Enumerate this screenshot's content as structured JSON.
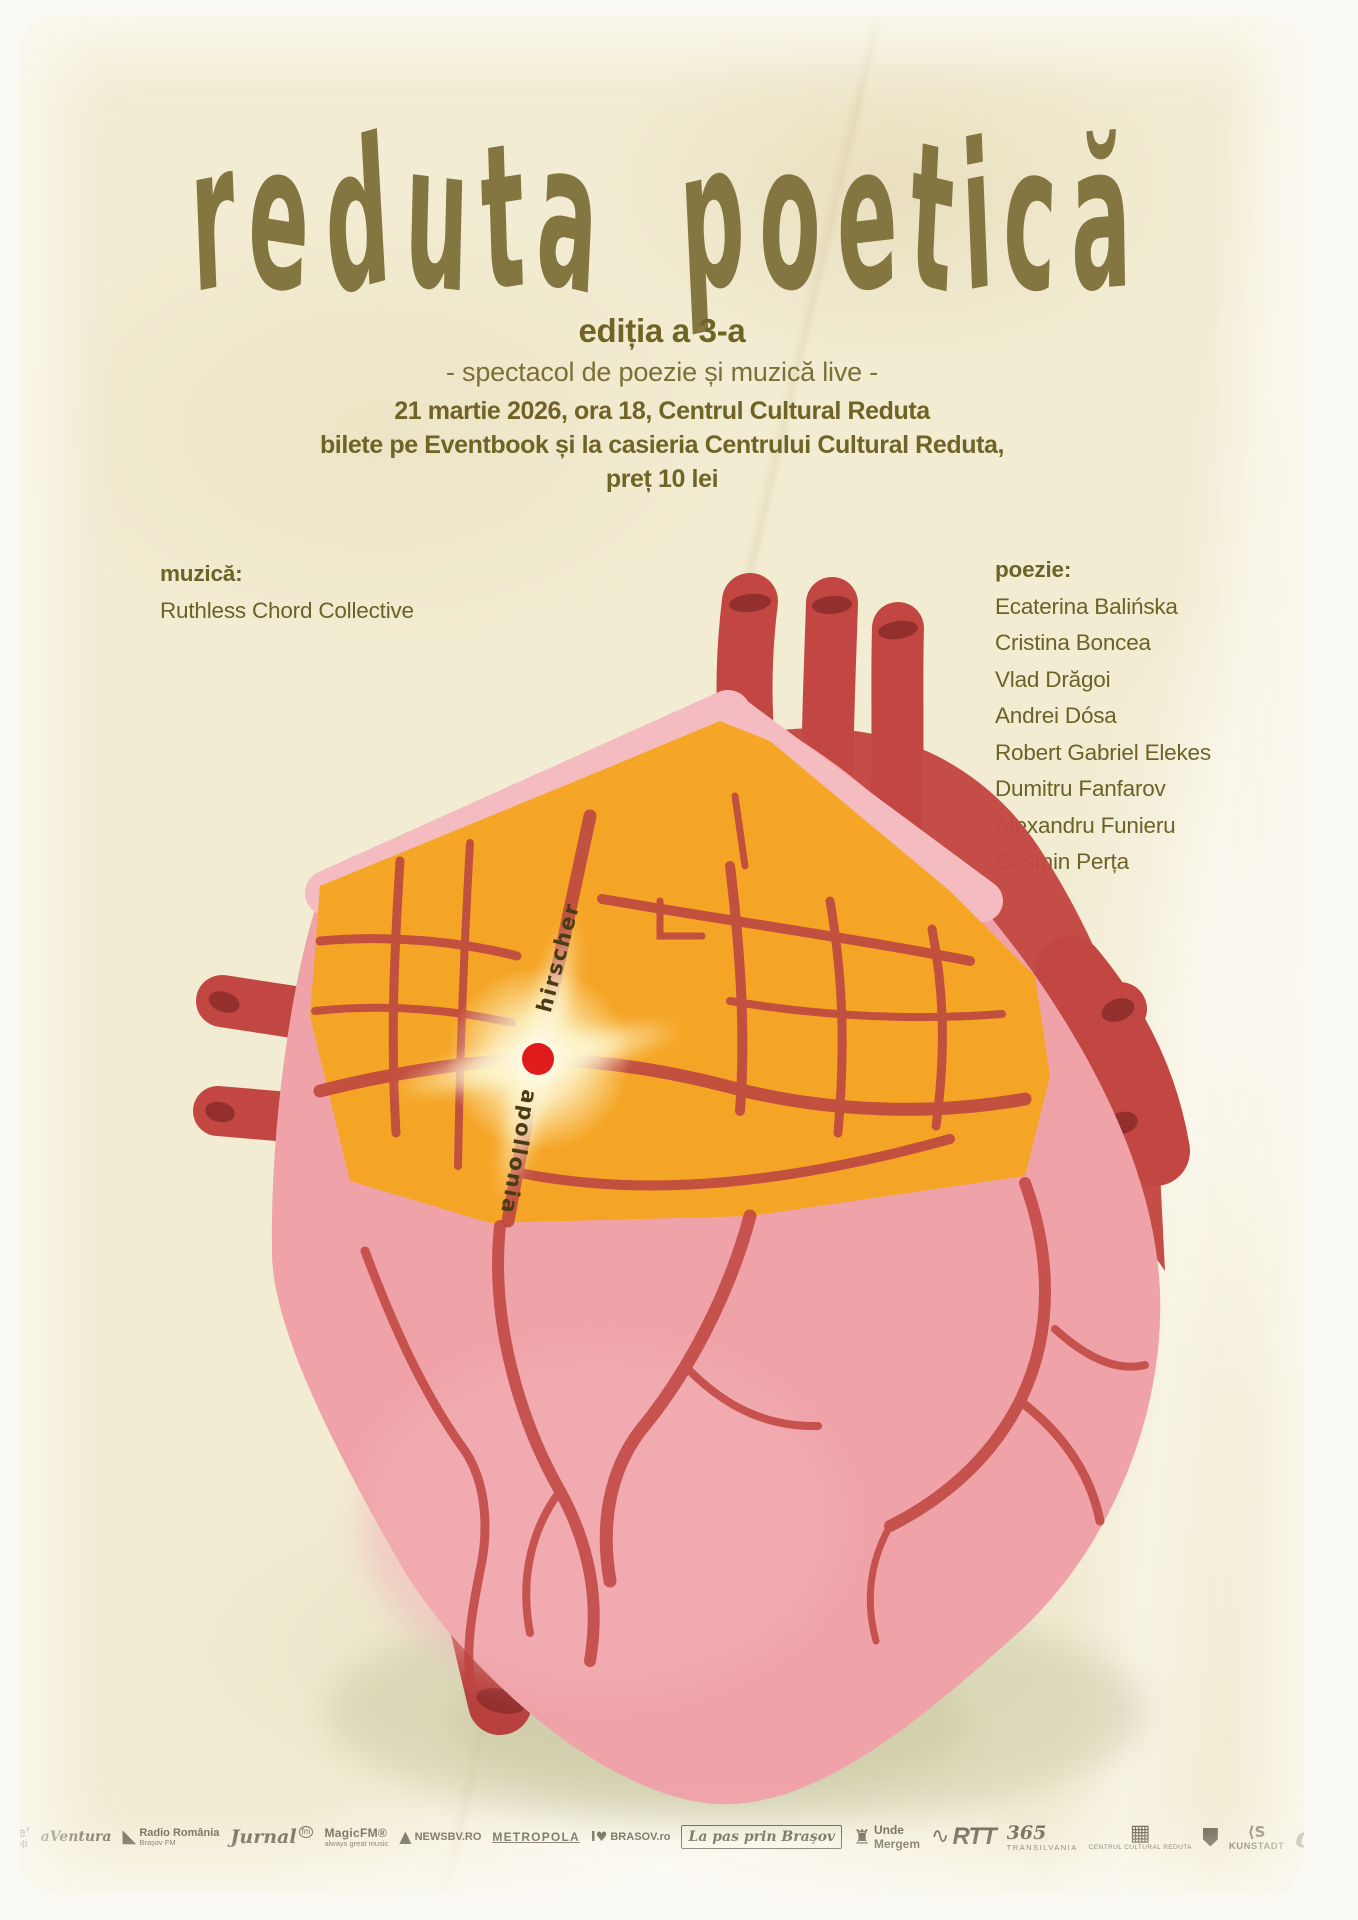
{
  "poster": {
    "title": "reduta poetică",
    "edition": "ediția a 3-a",
    "tagline": "- spectacol de poezie și muzică live -",
    "info_line1": "21 martie 2026, ora 18, Centrul Cultural Reduta",
    "info_line2": "bilete pe Eventbook și la casieria Centrului Cultural Reduta,",
    "info_line3": "preț 10 lei"
  },
  "music": {
    "label": "muzică:",
    "artist": "Ruthless Chord Collective"
  },
  "poetry": {
    "label": "poezie:",
    "poets": [
      "Ecaterina Balińska",
      "Cristina Boncea",
      "Vlad Drăgoi",
      "Andrei Dósa",
      "Robert Gabriel Elekes",
      "Dumitru Fanfarov",
      "Alexandru Funieru",
      "Cosmin Perța"
    ]
  },
  "map": {
    "street_label_1": "hirscher",
    "street_label_2": "apollonia"
  },
  "colors": {
    "paper_cream": "#f2ecd2",
    "title_ink": "#847641",
    "body_ink": "#6f6426",
    "heart_pink": "#efa3a8",
    "heart_pink_light": "#f4bcc0",
    "vessel_red": "#c24742",
    "map_orange": "#f5a522",
    "street_red": "#bf4a40",
    "marker_red": "#e01b1b",
    "glow_cream": "#fffbe2",
    "shadow_green": "#cfcdab",
    "logo_ink": "#433d29"
  },
  "footer": {
    "logos": [
      {
        "name": "round-emblem-logo-1",
        "cls": "circle",
        "glyph": "◉",
        "label": "",
        "sub": ""
      },
      {
        "name": "round-emblem-logo-2",
        "cls": "circle",
        "glyph": "◈",
        "label": "",
        "sub": ""
      },
      {
        "name": "zile-nopti-logo",
        "cls": "star",
        "glyph": "★",
        "label": "zile’",
        "sub": "nopți"
      },
      {
        "name": "aventura-logo",
        "cls": "script",
        "glyph": "",
        "label": "aVentura",
        "sub": ""
      },
      {
        "name": "radio-romania-brasov-logo",
        "cls": "radio",
        "glyph": "◣",
        "label": "Radio România",
        "sub": "Brașov FM"
      },
      {
        "name": "jurnal-fm-logo",
        "cls": "jurnal",
        "glyph": "",
        "label": "Jurnal",
        "sub": "fm"
      },
      {
        "name": "magic-fm-logo",
        "cls": "magic",
        "glyph": "",
        "label": "MagicFM®",
        "sub": "always great music"
      },
      {
        "name": "newsbv-logo",
        "cls": "news",
        "glyph": "▲",
        "label": "NEWSBV.RO",
        "sub": ""
      },
      {
        "name": "metropola-logo",
        "cls": "caps",
        "glyph": "",
        "label": "METROPOLA",
        "sub": ""
      },
      {
        "name": "ilovebrasov-logo",
        "cls": "ilb",
        "glyph": "I♥",
        "label": "BRASOV.ro",
        "sub": ""
      },
      {
        "name": "la-pas-prin-brasov-logo",
        "cls": "script box",
        "glyph": "",
        "label": "La pas prin Brașov",
        "sub": ""
      },
      {
        "name": "unde-mergem-logo",
        "cls": "unde",
        "glyph": "♜",
        "label": "Unde",
        "sub": "Mergem"
      },
      {
        "name": "rtt-logo",
        "cls": "rtt",
        "glyph": "∿",
        "label": "RTT",
        "sub": ""
      },
      {
        "name": "365-transilvania-logo",
        "cls": "n365",
        "glyph": "",
        "label": "365",
        "sub": "TRANSILVANIA"
      },
      {
        "name": "reduta-building-logo",
        "cls": "build",
        "glyph": "▦",
        "label": "",
        "sub": "CENTRUL CULTURAL REDUTA"
      },
      {
        "name": "coat-of-arms-logo",
        "cls": "arms",
        "shape": "shield",
        "glyph": "",
        "label": "",
        "sub": ""
      },
      {
        "name": "kunstadt-logo",
        "cls": "kun",
        "glyph": "⟨S",
        "label": "KUNSTADT",
        "sub": ""
      },
      {
        "name": "stylized-a-logo",
        "cls": "alogo",
        "glyph": "ɑ",
        "label": "",
        "sub": ""
      },
      {
        "name": "transilvania-university-logo",
        "cls": "uni",
        "glyph": "≣",
        "label": "Transilvania University",
        "sub": "of Brasov"
      }
    ]
  }
}
